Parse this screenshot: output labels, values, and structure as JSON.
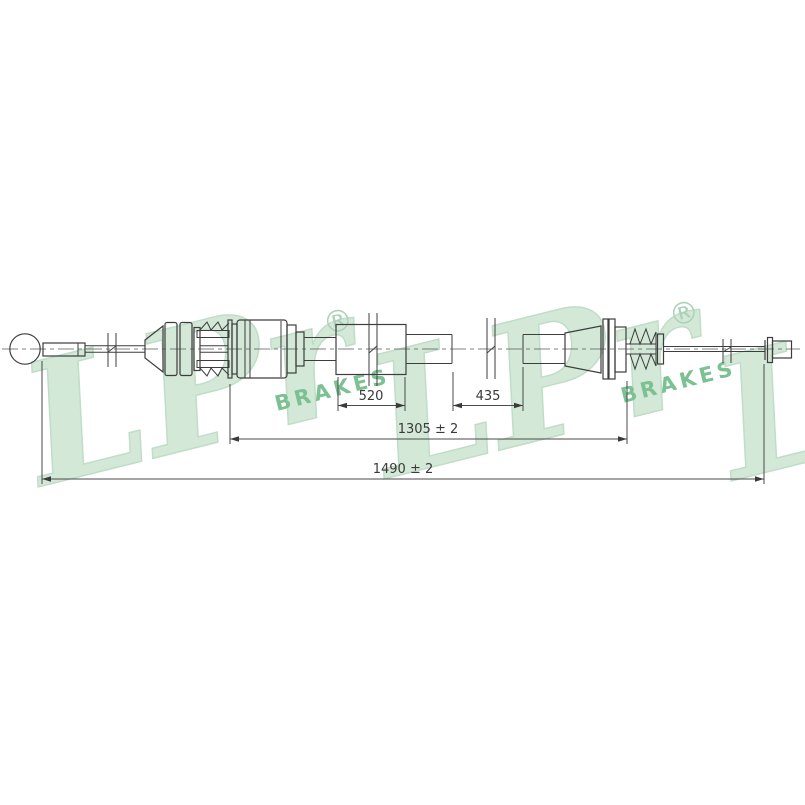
{
  "meta": {
    "type": "technical-line-drawing",
    "subject": "parking brake cable",
    "background_color": "#ffffff"
  },
  "watermark": {
    "brand": "LPr",
    "registered": "®",
    "sub_brand": "BRAKES",
    "color_big_letters": "#d3e8d7",
    "color_sub_brand": "#7bc191",
    "color_registered": "#abd2b8"
  },
  "drawing": {
    "line_color": "#3d3d3d",
    "dimension_color": "#3a3a3a",
    "dimensions": {
      "seg_520": {
        "label": "520"
      },
      "seg_435": {
        "label": "435"
      },
      "span_1305": {
        "label": "1305 ± 2"
      },
      "span_1490": {
        "label": "1490 ± 2"
      }
    }
  }
}
